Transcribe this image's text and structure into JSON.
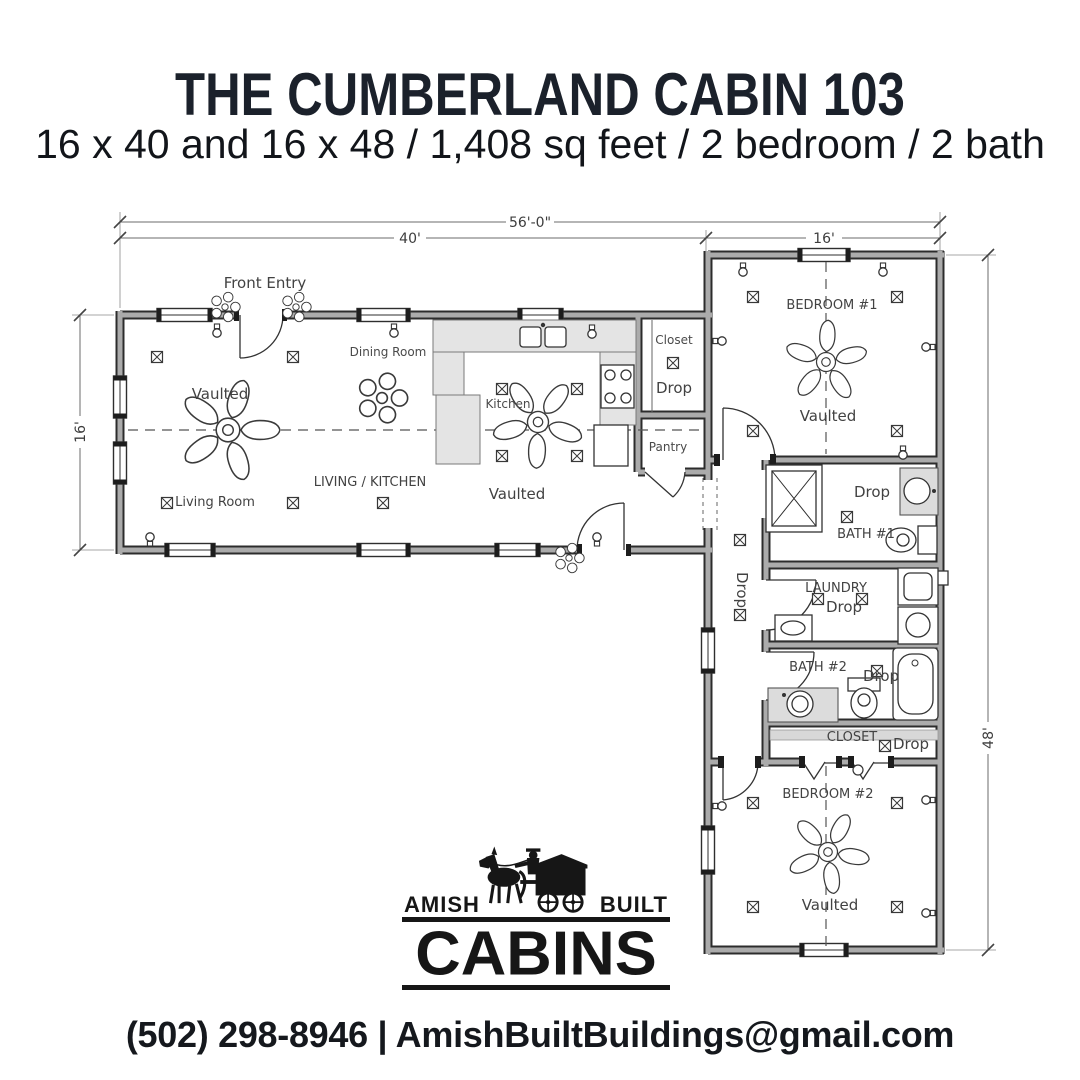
{
  "header": {
    "title": "THE CUMBERLAND CABIN 103",
    "subtitle": "16 x 40 and 16 x 48 / 1,408 sq feet / 2 bedroom / 2 bath"
  },
  "floorplan": {
    "dimensions": {
      "overall_width": "56'-0\"",
      "left_wing_width": "40'",
      "right_wing_width": "16'",
      "left_wing_depth": "16'",
      "right_wing_height": "48'"
    },
    "labels": {
      "front_entry": "Front Entry",
      "dining_room": "Dining Room",
      "kitchen": "Kitchen",
      "living_kitchen": "LIVING / KITCHEN",
      "living_room": "Living Room",
      "vaulted": "Vaulted",
      "closet": "Closet",
      "drop": "Drop",
      "pantry": "Pantry",
      "bedroom1": "BEDROOM #1",
      "bath1": "BATH #1",
      "laundry": "LAUNDRY",
      "bath2": "BATH #2",
      "closet2": "CLOSET",
      "bedroom2": "BEDROOM #2"
    }
  },
  "logo": {
    "word_left": "AMISH",
    "word_right": "BUILT",
    "word_main": "CABINS"
  },
  "footer": {
    "contact": "(502) 298-8946 | AmishBuiltBuildings@gmail.com"
  }
}
